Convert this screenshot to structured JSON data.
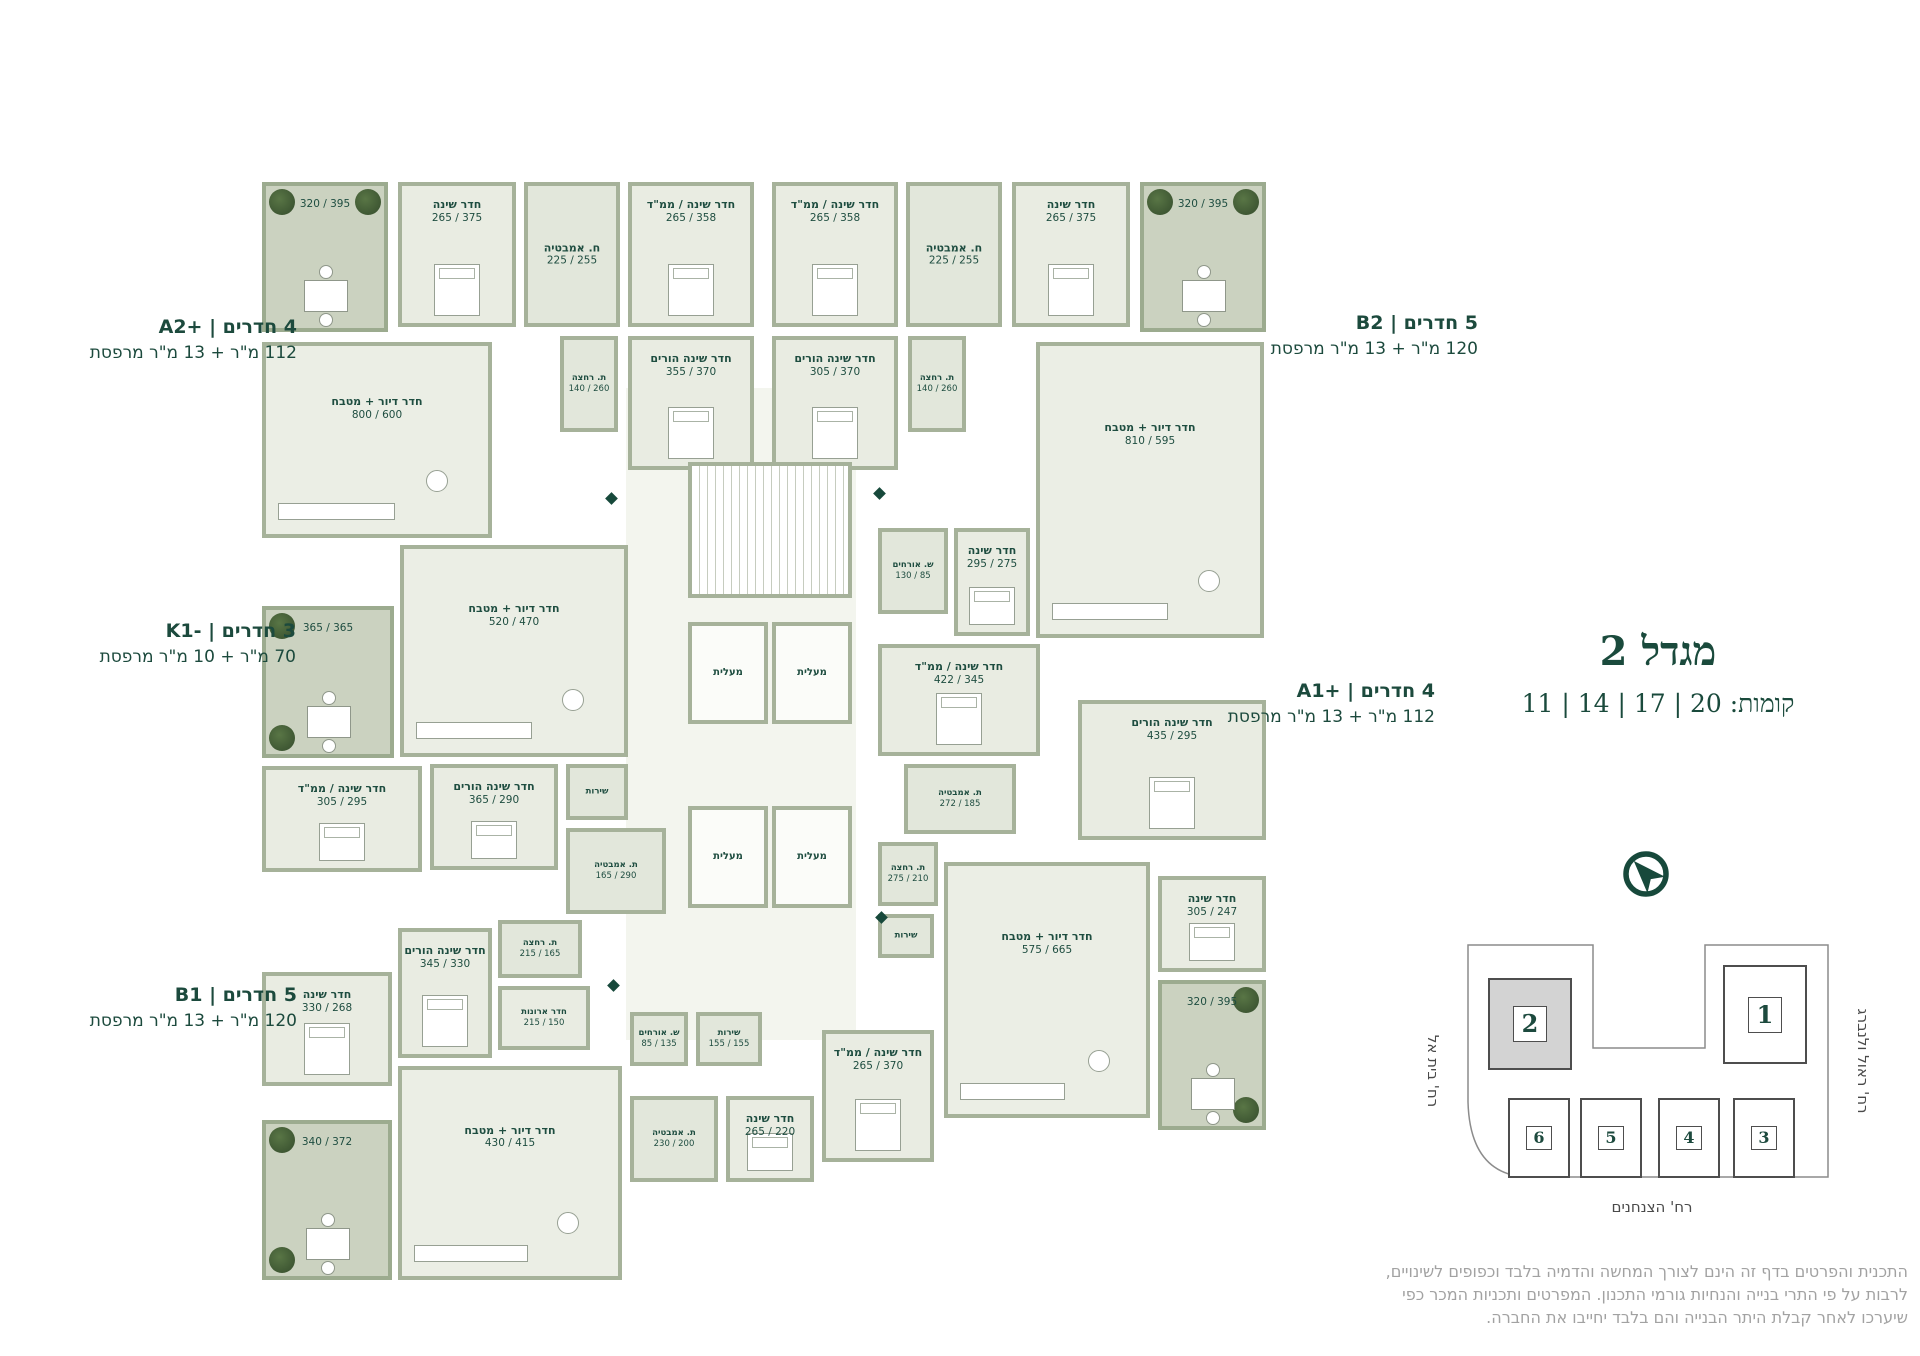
{
  "title": {
    "text": "מגדל 2",
    "floors": "קומות: 20 | 17 | 14 | 11"
  },
  "colors": {
    "accent": "#17493b",
    "wall": "#a6b29a",
    "room_fill": "#e9ece2",
    "balcony_fill": "#cbd2c0",
    "tree": "#2c4424",
    "building_highlight": "#d3d3d3",
    "disclaimer_text": "#a2a2a2"
  },
  "apartment_labels": [
    {
      "id": "a2plus",
      "line1": "4 חדרים | A2+‎",
      "line2": "112 מ\"ר + 13 מ\"ר מרפסת",
      "right": 1623,
      "top": 316
    },
    {
      "id": "b2",
      "line1": "5 חדרים | B2",
      "line2": "120 מ\"ר + 13 מ\"ר מרפסת",
      "right": 442,
      "top": 312
    },
    {
      "id": "k1minus",
      "line1": "3 חדרים | K1-‎",
      "line2": "70 מ\"ר + 10 מ\"ר מרפסת",
      "right": 1624,
      "top": 620
    },
    {
      "id": "a1plus",
      "line1": "4 חדרים | A1+‎",
      "line2": "112 מ\"ר + 13 מ\"ר מרפסת",
      "right": 485,
      "top": 680
    },
    {
      "id": "b1",
      "line1": "5 חדרים | B1",
      "line2": "120 מ\"ר + 13 מ\"ר מרפסת",
      "right": 1623,
      "top": 984
    }
  ],
  "plan": {
    "rooms": [
      {
        "t": "corridor",
        "x": 626,
        "y": 388,
        "w": 230,
        "h": 652
      },
      {
        "t": "balcony",
        "dims": "320 / 395",
        "x": 262,
        "y": 182,
        "w": 126,
        "h": 150,
        "trees": [
          "tl",
          "tr"
        ],
        "table": 1
      },
      {
        "t": "bedroom",
        "name": "חדר שינה",
        "dims": "265 / 375",
        "x": 398,
        "y": 182,
        "w": 118,
        "h": 145
      },
      {
        "t": "bath",
        "name": "ח. אמבטיה",
        "dims": "225 / 255",
        "x": 524,
        "y": 182,
        "w": 96,
        "h": 145
      },
      {
        "t": "bedroom",
        "name": "חדר שינה / ממ\"ד",
        "dims": "265 / 358",
        "x": 628,
        "y": 182,
        "w": 126,
        "h": 145
      },
      {
        "t": "bedroom",
        "name": "חדר שינה הורים",
        "dims": "355 / 370",
        "x": 628,
        "y": 336,
        "w": 126,
        "h": 134
      },
      {
        "t": "bath",
        "name": "ת. רחצה",
        "dims": "140 / 260",
        "x": 560,
        "y": 336,
        "w": 58,
        "h": 96,
        "small": 1
      },
      {
        "t": "living",
        "name": "חדר דיור + מטבח",
        "dims": "800 / 600",
        "x": 262,
        "y": 342,
        "w": 230,
        "h": 196
      },
      {
        "t": "bedroom",
        "name": "חדר שינה / ממ\"ד",
        "dims": "265 / 358",
        "x": 772,
        "y": 182,
        "w": 126,
        "h": 145
      },
      {
        "t": "bath",
        "name": "ח. אמבטיה",
        "dims": "225 / 255",
        "x": 906,
        "y": 182,
        "w": 96,
        "h": 145
      },
      {
        "t": "bedroom",
        "name": "חדר שינה",
        "dims": "265 / 375",
        "x": 1012,
        "y": 182,
        "w": 118,
        "h": 145
      },
      {
        "t": "balcony",
        "dims": "320 / 395",
        "x": 1140,
        "y": 182,
        "w": 126,
        "h": 150,
        "trees": [
          "tl",
          "tr"
        ],
        "table": 1
      },
      {
        "t": "bedroom",
        "name": "חדר שינה הורים",
        "dims": "305 / 370",
        "x": 772,
        "y": 336,
        "w": 126,
        "h": 134
      },
      {
        "t": "bath",
        "name": "ת. רחצה",
        "dims": "140 / 260",
        "x": 908,
        "y": 336,
        "w": 58,
        "h": 96,
        "small": 1
      },
      {
        "t": "living",
        "name": "חדר דיור + מטבח",
        "dims": "810 / 595",
        "x": 1036,
        "y": 342,
        "w": 228,
        "h": 296
      },
      {
        "t": "bath",
        "name": "ש. אורחים",
        "dims": "130 / 85",
        "x": 878,
        "y": 528,
        "w": 70,
        "h": 86,
        "small": 1
      },
      {
        "t": "bedroom",
        "name": "חדר שינה",
        "dims": "295 / 275",
        "x": 954,
        "y": 528,
        "w": 76,
        "h": 108
      },
      {
        "t": "bedroom",
        "name": "חדר שינה / ממ\"ד",
        "dims": "422 / 345",
        "x": 878,
        "y": 644,
        "w": 162,
        "h": 112
      },
      {
        "t": "bath",
        "name": "ת. אמבטיה",
        "dims": "272 / 185",
        "x": 904,
        "y": 764,
        "w": 112,
        "h": 70,
        "small": 1
      },
      {
        "t": "bedroom",
        "name": "חדר שינה הורים",
        "dims": "435 / 295",
        "x": 1078,
        "y": 700,
        "w": 188,
        "h": 140
      },
      {
        "t": "bath",
        "name": "ת. רחצה",
        "dims": "275 / 210",
        "x": 878,
        "y": 842,
        "w": 60,
        "h": 64,
        "small": 1
      },
      {
        "t": "bath",
        "name": "שירות",
        "x": 878,
        "y": 914,
        "w": 56,
        "h": 44,
        "small": 1
      },
      {
        "t": "living",
        "name": "חדר דיור + מטבח",
        "dims": "575 / 665",
        "x": 944,
        "y": 862,
        "w": 206,
        "h": 256
      },
      {
        "t": "bedroom",
        "name": "חדר שינה",
        "dims": "305 / 247",
        "x": 1158,
        "y": 876,
        "w": 108,
        "h": 96
      },
      {
        "t": "balcony",
        "dims": "320 / 395",
        "x": 1158,
        "y": 980,
        "w": 108,
        "h": 150,
        "trees": [
          "tr",
          "br"
        ],
        "table": 1
      },
      {
        "t": "balcony",
        "dims": "365 / 365",
        "x": 262,
        "y": 606,
        "w": 132,
        "h": 152,
        "trees": [
          "tl",
          "bl"
        ],
        "table": 1
      },
      {
        "t": "living",
        "name": "חדר דיור + מטבח",
        "dims": "520 / 470",
        "x": 400,
        "y": 545,
        "w": 228,
        "h": 212
      },
      {
        "t": "bedroom",
        "name": "חדר שינה / ממ\"ד",
        "dims": "305 / 295",
        "x": 262,
        "y": 766,
        "w": 160,
        "h": 106
      },
      {
        "t": "bath",
        "name": "שירות",
        "x": 566,
        "y": 764,
        "w": 62,
        "h": 56,
        "small": 1
      },
      {
        "t": "bedroom",
        "name": "חדר שינה הורים",
        "dims": "365 / 290",
        "x": 430,
        "y": 764,
        "w": 128,
        "h": 106
      },
      {
        "t": "bath",
        "name": "ת. אמבטיה",
        "dims": "165 / 290",
        "x": 566,
        "y": 828,
        "w": 100,
        "h": 86,
        "small": 1
      },
      {
        "t": "bath",
        "name": "ת. רחצה",
        "dims": "215 / 165",
        "x": 498,
        "y": 920,
        "w": 84,
        "h": 58,
        "small": 1
      },
      {
        "t": "bedroom",
        "name": "חדר שינה הורים",
        "dims": "345 / 330",
        "x": 398,
        "y": 928,
        "w": 94,
        "h": 130
      },
      {
        "t": "plain",
        "name": "חדר ארונות",
        "dims": "215 / 150",
        "x": 498,
        "y": 986,
        "w": 92,
        "h": 64,
        "small": 1
      },
      {
        "t": "bedroom",
        "name": "חדר שינה",
        "dims": "330 / 268",
        "x": 262,
        "y": 972,
        "w": 130,
        "h": 114
      },
      {
        "t": "living",
        "name": "חדר דיור + מטבח",
        "dims": "430 / 415",
        "x": 398,
        "y": 1066,
        "w": 224,
        "h": 214
      },
      {
        "t": "balcony",
        "dims": "340 / 372",
        "x": 262,
        "y": 1120,
        "w": 130,
        "h": 160,
        "trees": [
          "tl",
          "bl"
        ],
        "table": 1
      },
      {
        "t": "bath",
        "name": "ש. אורחים",
        "dims": "85 / 135",
        "x": 630,
        "y": 1012,
        "w": 58,
        "h": 54,
        "small": 1
      },
      {
        "t": "bath",
        "name": "שירות",
        "dims": "155 / 155",
        "x": 696,
        "y": 1012,
        "w": 66,
        "h": 54,
        "small": 1
      },
      {
        "t": "bath",
        "name": "ת. אמבטיה",
        "dims": "230 / 200",
        "x": 630,
        "y": 1096,
        "w": 88,
        "h": 86,
        "small": 1
      },
      {
        "t": "bedroom",
        "name": "חדר שינה",
        "dims": "265 / 220",
        "x": 726,
        "y": 1096,
        "w": 88,
        "h": 86
      },
      {
        "t": "bedroom",
        "name": "חדר שינה / ממ\"ד",
        "dims": "265 / 370",
        "x": 822,
        "y": 1030,
        "w": 112,
        "h": 132
      },
      {
        "t": "stairs",
        "x": 688,
        "y": 462,
        "w": 164,
        "h": 136
      },
      {
        "t": "elevator",
        "name": "מעלית",
        "x": 688,
        "y": 622,
        "w": 80,
        "h": 102
      },
      {
        "t": "elevator",
        "name": "מעלית",
        "x": 772,
        "y": 622,
        "w": 80,
        "h": 102
      },
      {
        "t": "elevator",
        "name": "מעלית",
        "x": 688,
        "y": 806,
        "w": 80,
        "h": 102
      },
      {
        "t": "elevator",
        "name": "מעלית",
        "x": 772,
        "y": 806,
        "w": 80,
        "h": 102
      }
    ],
    "entry_markers": [
      [
        607,
        494
      ],
      [
        875,
        489
      ],
      [
        609,
        981
      ],
      [
        877,
        913
      ]
    ]
  },
  "site_plan": {
    "buildings": [
      {
        "num": "2",
        "x": 38,
        "y": 48,
        "w": 80,
        "h": 88,
        "highlight": true
      },
      {
        "num": "1",
        "x": 273,
        "y": 35,
        "w": 80,
        "h": 95
      },
      {
        "num": "6",
        "x": 58,
        "y": 168,
        "w": 58,
        "h": 76,
        "small": true
      },
      {
        "num": "5",
        "x": 130,
        "y": 168,
        "w": 58,
        "h": 76,
        "small": true
      },
      {
        "num": "4",
        "x": 208,
        "y": 168,
        "w": 58,
        "h": 76,
        "small": true
      },
      {
        "num": "3",
        "x": 283,
        "y": 168,
        "w": 58,
        "h": 76,
        "small": true
      }
    ],
    "streets": [
      {
        "name": "רח' בית אל",
        "x": 1368,
        "y": 1062,
        "rot": 90,
        "w": 130
      },
      {
        "name": "רח' ראול ולנברג",
        "x": 1788,
        "y": 1052,
        "rot": 90,
        "w": 150
      },
      {
        "name": "רח' הצנחנים",
        "x": 1572,
        "y": 1198,
        "rot": 0,
        "w": 160
      }
    ]
  },
  "disclaimer": [
    "התכנית והפרטים בדף זה הינם לצורך המחשה והדמיה בלבד וכפופים לשינויים,",
    "לרבות על פי התרי בנייה והנחיות גורמי התכנון. המפרטים ותכניות המכר כפי",
    "שיערכו לאחר קבלת היתר הבנייה והם בלבד יחייבו את החברה."
  ]
}
